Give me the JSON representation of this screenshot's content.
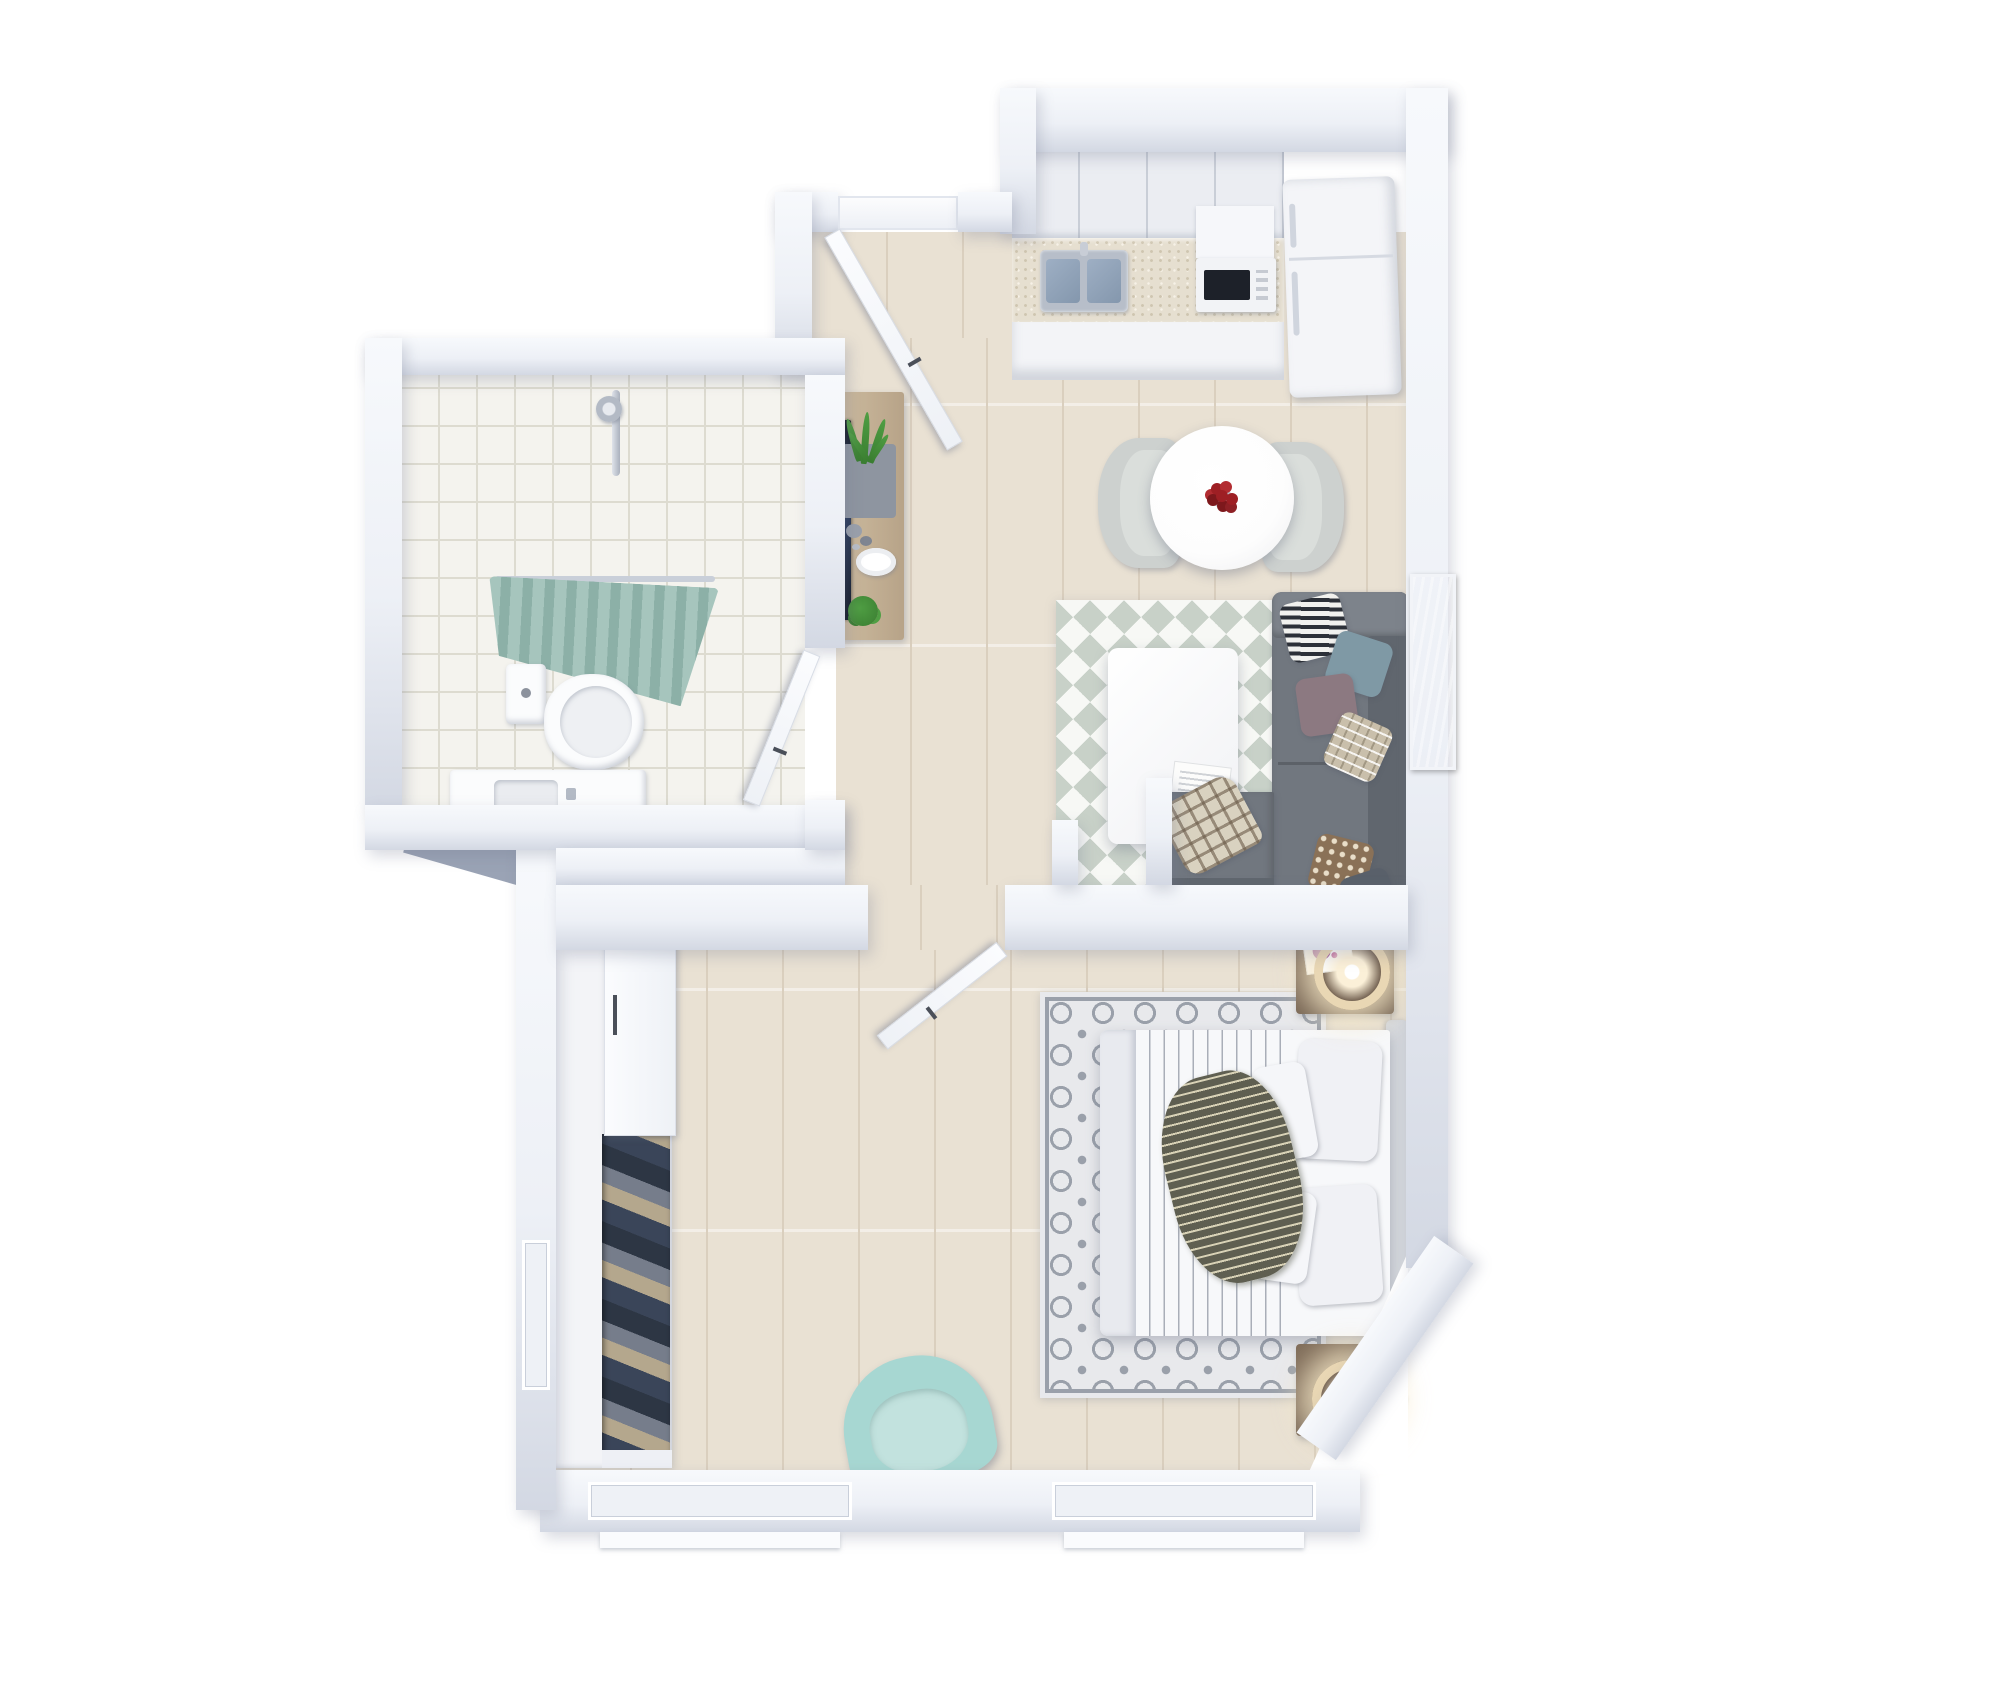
{
  "scene": {
    "colors": {
      "bg": "#ffffff",
      "wallHi": "#f7f9fc",
      "wallFace": "#edf0f6",
      "wallEdge": "#d3d8e3",
      "wallDark": "#9aa3b5",
      "floor": "#e9e1d3",
      "floorLine": "#dacfbe",
      "tile": "#f4f3ee",
      "tileLine": "#dddbd0",
      "counterTop": "#e6dfd0",
      "cabinet": "#ebedf2",
      "cabFront": "#f3f4f7",
      "steel": "#b7bec9",
      "basin": "#8497ad",
      "fridge": "#f4f5f8",
      "chair": "#cdd1cf",
      "chairSeat": "#dadedb",
      "tableWhite": "#fdfdfd",
      "red": "#9e1f24",
      "sofa": "#71777f",
      "sofaLight": "#7d838b",
      "sofaDark": "#60666e",
      "rugSage": "#c8d1c8",
      "rugWhite": "#f7f8f5",
      "bedRugBase": "#e8e9ec",
      "bedRugInk": "#9aa0aa",
      "duvet": "#f7f8fa",
      "duvetStripe": "#a9aeb8",
      "duvetFold": "#e8eaef",
      "pillowWhite": "#f0f1f5",
      "headboard": "#d5d8dd",
      "throwDark": "#5f5f51",
      "throwLight": "#d8d2b6",
      "mint": "#a7d7d2",
      "mintSeat": "#c2e2de",
      "curtain": "#a6c5bd",
      "curtainDark": "#8cb0a7",
      "rod": "#c9cfd9",
      "walnut": "#6a594a",
      "walnutTop": "#7e6b58",
      "consoleWood": "#cdbb9f",
      "consoleEdge": "#b7a388",
      "tv": "#151b29",
      "tvSheen": "#2b3c5e",
      "art": "#3e61a7",
      "artLight": "#8aa6d4",
      "leaf": "#4f9e43",
      "leafDark": "#3a7d31",
      "planter": "#8e95a0",
      "navy": "#3a4559",
      "beige": "#b4a78d",
      "grayCloth": "#767d8b",
      "darkCloth": "#2d3644",
      "lampRing": "#e9d7b4",
      "lampGlow": "#fbf0d8",
      "frameDark": "#394049",
      "porcelain": "#fbfcfd",
      "plaidBase": "#d9d2c0",
      "bwDark": "#2c3038",
      "bwLight": "#f1f1ee",
      "mauve": "#8c7981",
      "dustyBlue": "#7f99a5",
      "check": "#c9bfab",
      "dotBrown": "#8a7157",
      "pillowDkGray": "#59606a",
      "glass": "#eef1f6",
      "sill": "#fafbfd"
    },
    "rooms": {
      "kitchen_dining": {
        "items": [
          "wall-cabinets",
          "speckled-countertop",
          "double-sink",
          "faucet",
          "oven-cabinet",
          "microwave",
          "refrigerator",
          "round-dining-table",
          "red-flower-vase",
          "dining-chair-left",
          "dining-chair-right"
        ]
      },
      "living_room": {
        "items": [
          "triangle-pattern-rug",
          "coffee-table",
          "magazine",
          "sectional-sofa",
          "armrest",
          "backrest",
          "chaise",
          "pillow-striped-bw",
          "pillow-dusty-blue",
          "pillow-mauve",
          "pillow-check",
          "pillow-dotted",
          "pillow-dark-gray",
          "plaid-throw",
          "blue-wall-art",
          "tv",
          "tv-console",
          "grass-plant",
          "stone-vases",
          "decor-plate",
          "small-plant"
        ]
      },
      "bathroom": {
        "items": [
          "tile-floor",
          "shower-rail",
          "shower-head",
          "shower-curtain",
          "toilet",
          "vanity-sink",
          "open-door"
        ]
      },
      "hallway": {
        "items": [
          "entry-door-open",
          "threshold"
        ]
      },
      "bedroom": {
        "items": [
          "circle-pattern-rug",
          "double-bed",
          "striped-duvet",
          "duvet-fold",
          "knit-throw",
          "pillow-large-1",
          "pillow-large-2",
          "pillow-small-1",
          "pillow-small-2",
          "headboard",
          "nightstand-top",
          "nightstand-bottom",
          "ring-lamp-top",
          "ring-lamp-bottom",
          "book-with-flowers",
          "photo-frame",
          "mint-armchair",
          "wardrobe",
          "sliding-door",
          "hanging-clothes",
          "window-bottom-1",
          "window-bottom-2",
          "window-left",
          "open-door"
        ]
      }
    },
    "counts": {
      "sofa_pillows": 6,
      "bed_pillows": 4,
      "dining_chairs": 2,
      "nightstands": 2,
      "windows_bottom_wall": 2,
      "open_doors": 3
    }
  }
}
